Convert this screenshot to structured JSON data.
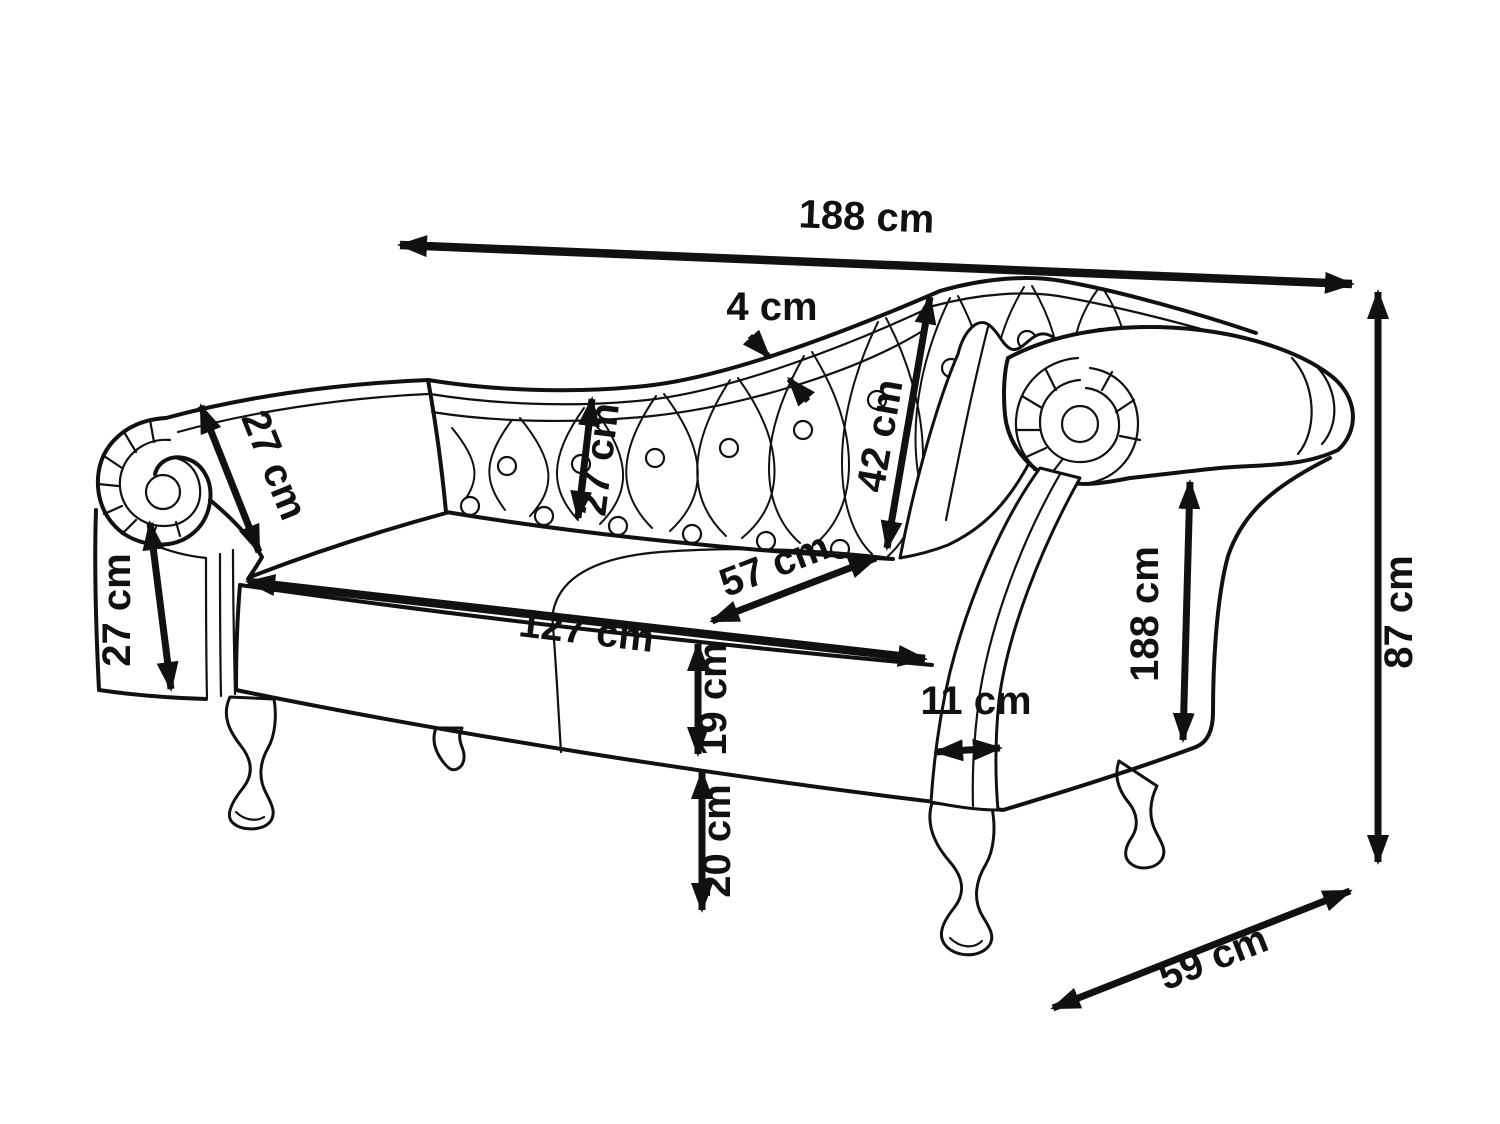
{
  "diagram": {
    "subject": "chaise longue dimension drawing",
    "background": "#ffffff",
    "line_color": "#111111",
    "dims": {
      "overall_length": "188 cm",
      "rail_thickness": "4 cm",
      "backrest_panel": "27 cm",
      "back_diagonal": "42 cm",
      "left_arm_top": "27 cm",
      "left_arm_front": "27 cm",
      "seat_depth": "57 cm",
      "seat_length": "127 cm",
      "base_height": "19 cm",
      "leg_height": "20 cm",
      "arm_support_width": "11 cm",
      "right_arm_length": "188 cm",
      "overall_height": "87 cm",
      "overall_depth": "59 cm"
    }
  }
}
